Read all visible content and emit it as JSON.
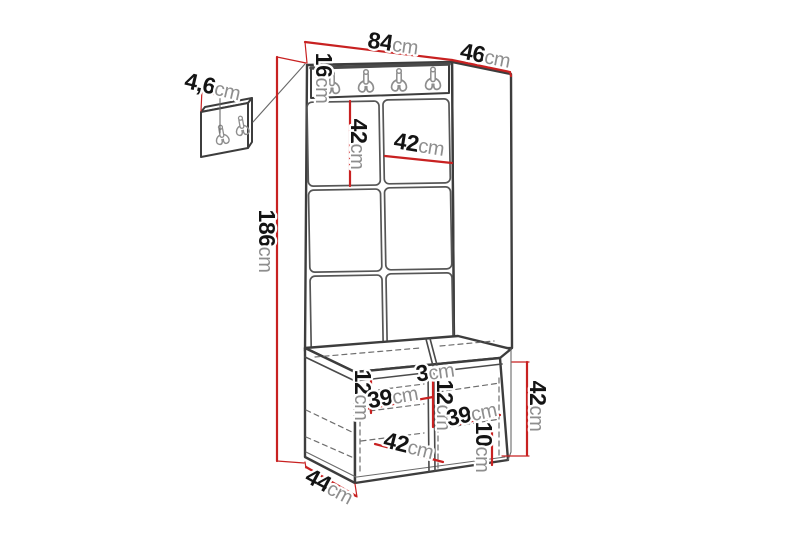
{
  "colors": {
    "dimension_red": "#c82121",
    "outline_dark": "#3d3d3d",
    "hook_gray": "#8d8d8d",
    "unit_text_gray": "#8e8e8e",
    "number_black": "#141414",
    "background": "#ffffff"
  },
  "icons": {
    "coat_hook": "double-prong-wall-hook"
  },
  "labels": {
    "top_width": {
      "num": "84",
      "unit": "cm"
    },
    "top_depth": {
      "num": "46",
      "unit": "cm"
    },
    "rail_height": {
      "num": "16",
      "unit": "cm"
    },
    "panel_height": {
      "num": "42",
      "unit": "cm"
    },
    "panel_width": {
      "num": "42",
      "unit": "cm"
    },
    "total_height": {
      "num": "186",
      "unit": "cm"
    },
    "mini_panel_depth": {
      "num": "4,6",
      "unit": "cm"
    },
    "seat_thickness": {
      "num": "3",
      "unit": "cm"
    },
    "left_gap_height": {
      "num": "12",
      "unit": "cm"
    },
    "left_shelf_width": {
      "num": "39",
      "unit": "cm"
    },
    "mid_gap_height": {
      "num": "12",
      "unit": "cm"
    },
    "right_shelf_width": {
      "num": "39",
      "unit": "cm"
    },
    "bench_front_width": {
      "num": "42",
      "unit": "cm"
    },
    "bottom_gap_height": {
      "num": "10",
      "unit": "cm"
    },
    "bench_height": {
      "num": "42",
      "unit": "cm"
    },
    "bench_depth": {
      "num": "44",
      "unit": "cm"
    }
  }
}
